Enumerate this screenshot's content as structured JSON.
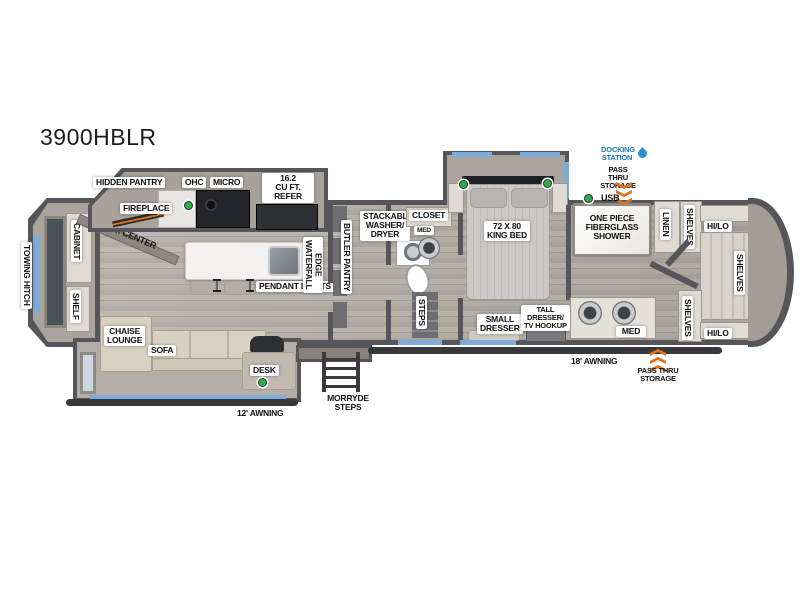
{
  "title": "3900HBLR",
  "colors": {
    "accent_blue": "#1b75bc",
    "accent_orange": "#e2711d",
    "accent_green": "#2fae47",
    "window_blue": "#7cabdc",
    "wall_gray": "#56565a"
  },
  "labels": {
    "towing_hitch": "TOWING HITCH",
    "cabinet": "CABINET",
    "shelf": "SHELF",
    "ent_center": "ENT. CENTER",
    "hidden_pantry": "HIDDEN PANTRY",
    "fireplace": "FIREPLACE",
    "ohc": "OHC",
    "micro": "MICRO",
    "refer": "16.2\nCU FT.\nREFER",
    "waterfall_edge": "WATERFALL\nEDGE",
    "pendant_lights": "PENDANT LIGHTS",
    "butler_pantry": "BUTLER PANTRY",
    "stackable_washer_dryer": "STACKABLE\nWASHER/\nDRYER",
    "closet": "CLOSET",
    "med_mid_bath": "MED",
    "steps_mid": "STEPS",
    "king_bed": "72 X 80\nKING BED",
    "small_dresser": "SMALL\nDRESSER",
    "tall_dresser": "TALL\nDRESSER/\nTV HOOKUP",
    "shower": "ONE PIECE\nFIBERGLASS\nSHOWER",
    "linen": "LINEN",
    "shelves_bath_top": "SHELVES",
    "shelves_bath_bottom": "SHELVES",
    "shelves_rear": "SHELVES",
    "hi_lo_top": "HI/LO",
    "hi_lo_bottom": "HI/LO",
    "med_rear_bath": "MED",
    "chaise_lounge": "CHAISE\nLOUNGE",
    "sofa": "SOFA",
    "desk": "DESK",
    "morryde_steps": "MORRYDE\nSTEPS",
    "awning_12": "12' AWNING",
    "awning_18": "18' AWNING",
    "docking_station": "DOCKING\nSTATION",
    "pass_thru_top": "PASS THRU\nSTORAGE",
    "pass_thru_bottom": "PASS THRU\nSTORAGE",
    "usb": "USB"
  },
  "icons": {
    "docking": "water-drop-icon",
    "pass_thru": "double-chevron-arrows",
    "power_markers": "green-dot"
  }
}
